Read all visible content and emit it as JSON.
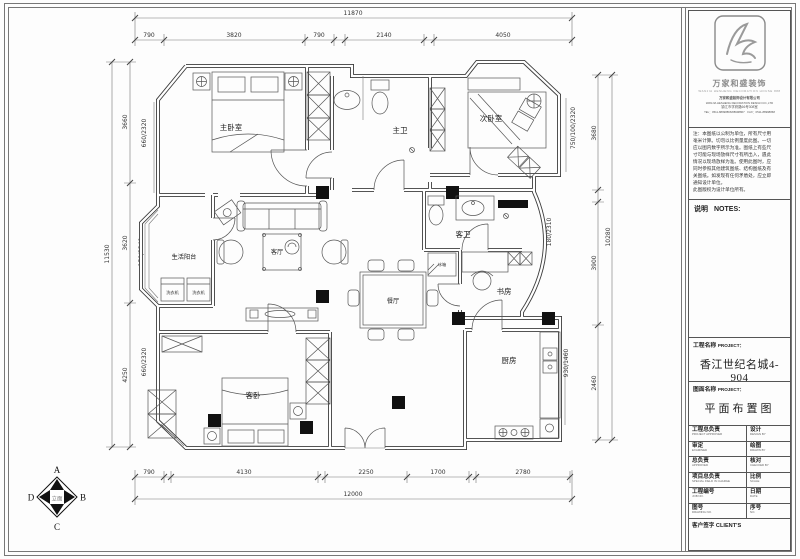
{
  "plan": {
    "rooms": {
      "master_bedroom": "主卧室",
      "master_bath": "主卫",
      "second_bedroom": "次卧室",
      "balcony": "生活阳台",
      "living": "客厅",
      "dining": "餐厅",
      "guest_bath": "客卫",
      "study": "书房",
      "kitchen": "厨房",
      "guest_bedroom": "客卧"
    },
    "appliances": {
      "washer1": "洗衣机",
      "washer2": "洗衣机",
      "fridge": "冰箱"
    },
    "dims": {
      "top_overall": "11870",
      "top": [
        "790",
        "3820",
        "790",
        "2140",
        "4050"
      ],
      "bottom": [
        "790",
        "4130",
        "2250",
        "1700",
        "2780"
      ],
      "bottom_overall": "12000",
      "left_overall": "11530",
      "left": [
        "3660",
        "3620",
        "4250"
      ],
      "left_inner": [
        "660/2320",
        "150/2340",
        "660/2320"
      ],
      "right_overall": "10280",
      "right": [
        "3680",
        "3900",
        "2460"
      ],
      "right_inner": [
        "750/100/2320",
        "180/2310",
        "930/1460"
      ]
    },
    "marker": {
      "top": "A",
      "right": "B",
      "bottom": "C",
      "left": "D",
      "center": "立面"
    }
  },
  "title_block": {
    "brand_cn": "万家和盛装饰",
    "brand_en": "WANJIA HESHENG DECORATION HOUSE 888",
    "company_lines": [
      "万家和盛装饰设计有限公司",
      "WANJIA HESHENG DECORATION DESIGN CO.,LTD",
      "镇江市学府路66号308室",
      "TEL：0511-88998866/88998867　FAX：0511-88998868"
    ],
    "note_lines": [
      "注：本图纸以公制为单位，所有尺寸用",
      "毫米计算。切勿以比例量度此图。一切",
      "应以图内数字所示为准。图纸上有些尺",
      "寸可能与现场放样尺寸有所出入，遇此",
      "情况以现场放样为准。使用此图时，应",
      "同时参照其他建筑图纸、结构图纸及有",
      "关图纸。如发现有任何矛盾处，应立即",
      "通知设计单位。",
      "此图版权为设计单位所有。"
    ],
    "notes_label": "说明",
    "notes_en": "NOTES:",
    "project_label_cn": "工程名称",
    "project_label_en": "PROJECT：",
    "project_value": "香江世纪名城4-904",
    "drawing_label_cn": "图面名称",
    "drawing_label_en": "PROJECT：",
    "drawing_value": "平面布置图",
    "table": {
      "rows": [
        {
          "l_cn": "工程总负责",
          "l_en": "PROJECT APPROVER",
          "r_cn": "设计",
          "r_en": "DESIGN BY"
        },
        {
          "l_cn": "审定",
          "l_en": "EXAMINED",
          "r_cn": "绘图",
          "r_en": "DRAWN BY"
        },
        {
          "l_cn": "总负责",
          "l_en": "APPROVED",
          "r_cn": "核对",
          "r_en": "CHECKED BY"
        },
        {
          "l_cn": "项目总负责",
          "l_en": "SPECIAL FIELD IN CHARGE",
          "r_cn": "比例",
          "r_en": "SCALE"
        },
        {
          "l_cn": "工程编号",
          "l_en": "JOB NO.",
          "r_cn": "日期",
          "r_en": "DATE"
        },
        {
          "l_cn": "图号",
          "l_en": "DRAWING NO.",
          "r_cn": "序号",
          "r_en": "NO."
        }
      ],
      "client_row": "客户签字 CLIENT'S"
    }
  }
}
